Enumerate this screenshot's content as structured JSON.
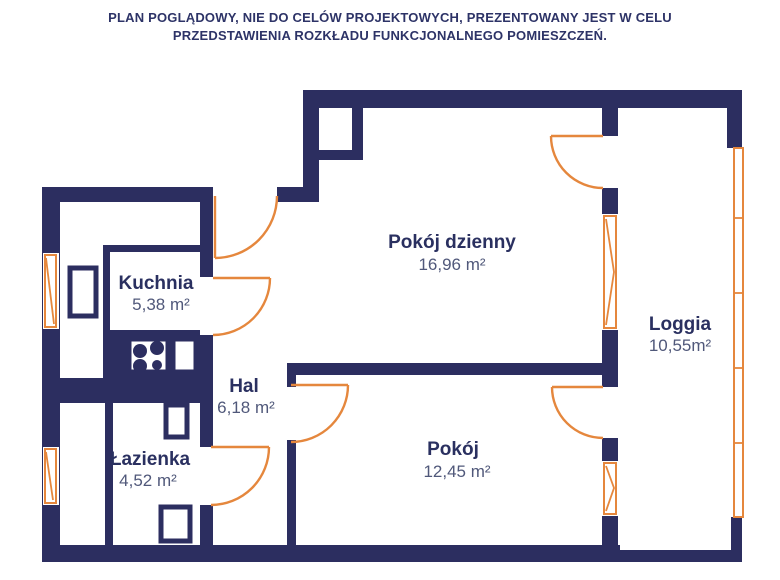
{
  "header": {
    "line1": "PLAN POGLĄDOWY, NIE DO CELÓW PROJEKTOWYCH, PREZENTOWANY JEST W CELU",
    "line2": "PRZEDSTAWIENIA ROZKŁADU FUNKCJONALNEGO POMIESZCZEŃ."
  },
  "rooms": [
    {
      "name": "Kuchnia",
      "area": "5,38 m²"
    },
    {
      "name": "Pokój dzienny",
      "area": "16,96 m²"
    },
    {
      "name": "Hal",
      "area": "6,18 m²"
    },
    {
      "name": "Łazienka",
      "area": "4,52 m²"
    },
    {
      "name": "Pokój",
      "area": "12,45 m²"
    },
    {
      "name": "Loggia",
      "area": "10,55m²"
    }
  ],
  "colors": {
    "wall_navy": "#2c2e60",
    "accent_orange": "#e5873d",
    "room_name_text": "#2a3060",
    "area_text": "#50587a",
    "header_text": "#2d3367",
    "background": "#ffffff"
  }
}
